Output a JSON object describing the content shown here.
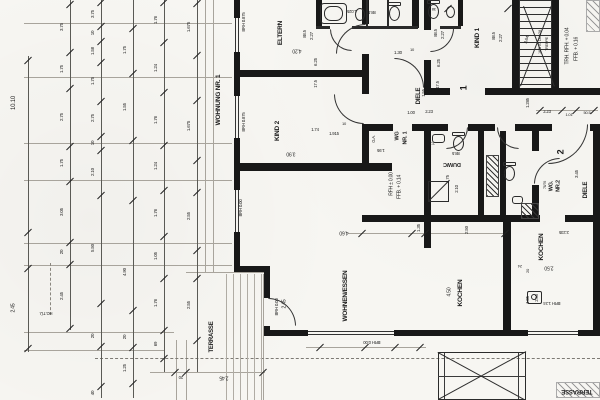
{
  "drawing": {
    "colors": {
      "paper": "#f7f6f2",
      "ink": "#1c1c1c",
      "light_line": "#a8a49c"
    },
    "rooms": [
      {
        "t": "WOHNUNG NR. 1",
        "x": 219,
        "y": 100,
        "r": -90,
        "s": 6.5
      },
      {
        "t": "ELTERN",
        "x": 281,
        "y": 33,
        "r": -90,
        "s": 6.5
      },
      {
        "t": "KIND 2",
        "x": 278,
        "y": 131,
        "r": -90,
        "s": 6.5
      },
      {
        "t": "KIND 1",
        "x": 478,
        "y": 38,
        "r": -90,
        "s": 6.5
      },
      {
        "t": "DIELE",
        "x": 419,
        "y": 96,
        "r": -90,
        "s": 6
      },
      {
        "t": "WOHNEN/ESSEN",
        "x": 346,
        "y": 296,
        "r": -90,
        "s": 6.5
      },
      {
        "t": "KOCHEN",
        "x": 461,
        "y": 293,
        "r": -90,
        "s": 6.5
      },
      {
        "t": "KOCHEN",
        "x": 542,
        "y": 247,
        "r": -90,
        "s": 6.5
      },
      {
        "t": "DU/WC",
        "x": 452,
        "y": 163,
        "r": 180,
        "s": 5.5
      },
      {
        "t": "WC",
        "x": 504,
        "y": 176,
        "r": -90,
        "s": 5.5
      },
      {
        "t": "WG",
        "x": 398,
        "y": 136,
        "r": -90,
        "s": 5.5
      },
      {
        "t": "NR. 1",
        "x": 406,
        "y": 138,
        "r": -90,
        "s": 5.5
      },
      {
        "t": "WG.",
        "x": 552,
        "y": 186,
        "r": -90,
        "s": 5.5
      },
      {
        "t": "NR.2",
        "x": 559,
        "y": 186,
        "r": -90,
        "s": 5.5
      },
      {
        "t": "DIELE",
        "x": 586,
        "y": 190,
        "r": -90,
        "s": 6
      },
      {
        "t": "TERRASSE",
        "x": 212,
        "y": 337,
        "r": -90,
        "s": 6
      },
      {
        "t": "TERRASSE",
        "x": 577,
        "y": 391,
        "r": 180,
        "s": 6
      },
      {
        "t": "1",
        "x": 464,
        "y": 88,
        "r": -90,
        "s": 9
      },
      {
        "t": "2",
        "x": 561,
        "y": 152,
        "r": -90,
        "s": 9
      }
    ],
    "texts": [
      {
        "t": "88.5",
        "x": 305,
        "y": 34,
        "r": -90,
        "s": 4.3
      },
      {
        "t": "2.27",
        "x": 312,
        "y": 36,
        "r": -90,
        "s": 4.5
      },
      {
        "t": "4.20",
        "x": 297,
        "y": 50,
        "r": 180,
        "s": 5
      },
      {
        "t": "6.25",
        "x": 316,
        "y": 62,
        "r": -90,
        "s": 4.5
      },
      {
        "t": "17.5",
        "x": 316,
        "y": 84,
        "r": -90,
        "s": 4.3
      },
      {
        "t": "88.5",
        "x": 436,
        "y": 33,
        "r": -90,
        "s": 4.3
      },
      {
        "t": "2.27",
        "x": 443,
        "y": 35,
        "r": -90,
        "s": 4.5
      },
      {
        "t": "6.25",
        "x": 439,
        "y": 63,
        "r": -90,
        "s": 4.5
      },
      {
        "t": "17.5",
        "x": 438,
        "y": 85,
        "r": -90,
        "s": 4.3
      },
      {
        "t": "1.30",
        "x": 398,
        "y": 53,
        "r": 0,
        "s": 4.5
      },
      {
        "t": "10",
        "x": 412,
        "y": 50,
        "r": 0,
        "s": 4
      },
      {
        "t": "1.025",
        "x": 352,
        "y": 11,
        "r": 180,
        "s": 4.3
      },
      {
        "t": "88.5",
        "x": 372,
        "y": 12,
        "r": 180,
        "s": 4.3
      },
      {
        "t": "38",
        "x": 434,
        "y": 9,
        "r": 180,
        "s": 4
      },
      {
        "t": "88.5",
        "x": 494,
        "y": 36,
        "r": -90,
        "s": 4.3
      },
      {
        "t": "2.27",
        "x": 501,
        "y": 38,
        "r": -90,
        "s": 4.5
      },
      {
        "t": "3.75",
        "x": 461,
        "y": 11,
        "r": -90,
        "s": 4.5
      },
      {
        "t": "3.64",
        "x": 527,
        "y": 40,
        "r": -72,
        "s": 4.5
      },
      {
        "t": "18 STG 18.3/28",
        "x": 541,
        "y": 42,
        "r": -90,
        "s": 3.8
      },
      {
        "t": "TREPPE",
        "x": 548,
        "y": 44,
        "r": -90,
        "s": 3.8
      },
      {
        "t": "TRH. RFH. + 0.04",
        "x": 568,
        "y": 46,
        "r": -90,
        "s": 5
      },
      {
        "t": "FFB. + 0.16",
        "x": 577,
        "y": 49,
        "r": -90,
        "s": 5
      },
      {
        "t": "1.285",
        "x": 528,
        "y": 103,
        "r": -90,
        "s": 4.3
      },
      {
        "t": "2.23",
        "x": 547,
        "y": 112,
        "r": 0,
        "s": 4.3
      },
      {
        "t": "1.01",
        "x": 569,
        "y": 115,
        "r": 0,
        "s": 4
      },
      {
        "t": "50.5",
        "x": 587,
        "y": 113,
        "r": 0,
        "s": 4
      },
      {
        "t": "1.00",
        "x": 411,
        "y": 113,
        "r": 0,
        "s": 4.3
      },
      {
        "t": "2.23",
        "x": 429,
        "y": 112,
        "r": 0,
        "s": 4.3
      },
      {
        "t": "1.55",
        "x": 424,
        "y": 93,
        "r": -90,
        "s": 4.3
      },
      {
        "t": "1.74",
        "x": 315,
        "y": 130,
        "r": 0,
        "s": 4.3
      },
      {
        "t": "1.915",
        "x": 334,
        "y": 134,
        "r": 0,
        "s": 4.3
      },
      {
        "t": "10",
        "x": 344,
        "y": 124,
        "r": 0,
        "s": 4
      },
      {
        "t": "3.90",
        "x": 291,
        "y": 153,
        "r": 180,
        "s": 5
      },
      {
        "t": "1.95",
        "x": 381,
        "y": 150,
        "r": 180,
        "s": 4.3
      },
      {
        "t": "G.A.",
        "x": 374,
        "y": 139,
        "r": -90,
        "s": 4.2
      },
      {
        "t": "2.27",
        "x": 431,
        "y": 143,
        "r": 180,
        "s": 4.3
      },
      {
        "t": "88.5",
        "x": 456,
        "y": 153,
        "r": 180,
        "s": 4.3
      },
      {
        "t": "1.75",
        "x": 448,
        "y": 179,
        "r": -90,
        "s": 4.3
      },
      {
        "t": "2.10",
        "x": 457,
        "y": 189,
        "r": -90,
        "s": 4.3
      },
      {
        "t": "RFH ± 0.00",
        "x": 392,
        "y": 184,
        "r": -90,
        "s": 5
      },
      {
        "t": "FFB. + 0.14",
        "x": 400,
        "y": 187,
        "r": -90,
        "s": 5
      },
      {
        "t": "BRH 0.875",
        "x": 244,
        "y": 22,
        "r": -90,
        "s": 4.3
      },
      {
        "t": "BRH 0.875",
        "x": 244,
        "y": 122,
        "r": -90,
        "s": 4.3
      },
      {
        "t": "BRH 0.00",
        "x": 241,
        "y": 208,
        "r": -90,
        "s": 4.3
      },
      {
        "t": "BRH 0.00",
        "x": 277,
        "y": 307,
        "r": -90,
        "s": 4.3
      },
      {
        "t": "BRH 0.00",
        "x": 372,
        "y": 342,
        "r": 180,
        "s": 4.3
      },
      {
        "t": "BRH 1.24",
        "x": 552,
        "y": 303,
        "r": 180,
        "s": 4.3
      },
      {
        "t": "4.60",
        "x": 344,
        "y": 232,
        "r": 180,
        "s": 5
      },
      {
        "t": "1.35",
        "x": 419,
        "y": 228,
        "r": -90,
        "s": 4.5
      },
      {
        "t": "2.50",
        "x": 467,
        "y": 230,
        "r": -90,
        "s": 4.5
      },
      {
        "t": "4.50",
        "x": 450,
        "y": 292,
        "r": -90,
        "s": 5
      },
      {
        "t": "2.50",
        "x": 549,
        "y": 267,
        "r": 180,
        "s": 5
      },
      {
        "t": "2.235",
        "x": 564,
        "y": 232,
        "r": 180,
        "s": 4.3
      },
      {
        "t": "24",
        "x": 520,
        "y": 266,
        "r": 180,
        "s": 4
      },
      {
        "t": "2.45",
        "x": 285,
        "y": 304,
        "r": -90,
        "s": 5
      },
      {
        "t": "1.05",
        "x": 528,
        "y": 300,
        "r": -90,
        "s": 4.3
      },
      {
        "t": "2.55",
        "x": 537,
        "y": 298,
        "r": -90,
        "s": 4.3
      },
      {
        "t": "20",
        "x": 528,
        "y": 271,
        "r": -90,
        "s": 4
      },
      {
        "t": "20",
        "x": 181,
        "y": 377,
        "r": 180,
        "s": 4.3
      },
      {
        "t": "2.45",
        "x": 224,
        "y": 377,
        "r": 180,
        "s": 5
      },
      {
        "t": "HG.TÜ.",
        "x": 46,
        "y": 313,
        "r": 180,
        "s": 4.2
      },
      {
        "t": "3.45",
        "x": 577,
        "y": 174,
        "r": -90,
        "s": 4.5
      },
      {
        "t": "78/76",
        "x": 546,
        "y": 185,
        "r": -90,
        "s": 3.6
      }
    ],
    "chains": [
      {
        "x": 28,
        "y1": 56,
        "y2": 352,
        "lx": -14,
        "ticks": [
          60,
          232,
          268,
          348
        ],
        "dims": [
          {
            "t": "10.10",
            "y": 103,
            "s": 6
          },
          {
            "t": "2.45",
            "y": 308,
            "s": 5
          }
        ]
      },
      {
        "x": 70,
        "y1": 0,
        "y2": 330,
        "ticks": [
          4,
          52,
          88,
          146,
          181,
          242,
          264,
          328
        ],
        "dims": [
          {
            "t": "3.75",
            "y": 27
          },
          {
            "t": "1.75",
            "y": 69
          },
          {
            "t": "2.75",
            "y": 117
          },
          {
            "t": "1.75",
            "y": 163
          },
          {
            "t": "3.05",
            "y": 212
          },
          {
            "t": "20",
            "y": 252
          },
          {
            "t": "2.45",
            "y": 296
          }
        ]
      },
      {
        "x": 101,
        "y1": 0,
        "y2": 398,
        "ticks": [
          2,
          26,
          41,
          62,
          101,
          136,
          150,
          195,
          303,
          346,
          386
        ],
        "dims": [
          {
            "t": "3.75",
            "y": 14
          },
          {
            "t": "10",
            "y": 33
          },
          {
            "t": "1.58",
            "y": 51
          },
          {
            "t": "1.75",
            "y": 81
          },
          {
            "t": "2.75",
            "y": 118
          },
          {
            "t": "10",
            "y": 143
          },
          {
            "t": "2.10",
            "y": 172
          },
          {
            "t": "5.50",
            "y": 248
          },
          {
            "t": "20",
            "y": 336
          },
          {
            "t": "40",
            "y": 393
          }
        ]
      },
      {
        "x": 133,
        "y1": 0,
        "y2": 398,
        "ticks": [
          28,
          73,
          140,
          200,
          310,
          347,
          383
        ],
        "dims": [
          {
            "t": "1.75",
            "y": 50
          },
          {
            "t": "1.55",
            "y": 107
          },
          {
            "t": "4.90",
            "y": 272
          },
          {
            "t": "20",
            "y": 337
          },
          {
            "t": "1.25",
            "y": 368
          }
        ]
      },
      {
        "x": 164,
        "y1": 0,
        "y2": 372,
        "ticks": [
          2,
          42,
          92,
          145,
          190,
          236,
          278,
          330,
          358
        ],
        "dims": [
          {
            "t": "1.76",
            "y": 20
          },
          {
            "t": "1.24",
            "y": 68
          },
          {
            "t": "1.76",
            "y": 120
          },
          {
            "t": "1.24",
            "y": 166
          },
          {
            "t": "1.76",
            "y": 213
          },
          {
            "t": "1.05",
            "y": 256
          },
          {
            "t": "1.76",
            "y": 303
          },
          {
            "t": "69",
            "y": 344
          }
        ]
      },
      {
        "x": 197,
        "y1": 0,
        "y2": 372,
        "ticks": [
          3,
          55,
          100,
          160,
          192,
          250,
          278,
          340
        ],
        "dims": [
          {
            "t": "1.675",
            "y": 27
          },
          {
            "t": "1.675",
            "y": 126
          },
          {
            "t": "2.55",
            "y": 216
          },
          {
            "t": "2.55",
            "y": 305
          }
        ]
      }
    ],
    "stair": {
      "flight_text": "18 STG 18.3/28",
      "name": "TREPPE",
      "run_dimension": "3.64"
    }
  }
}
